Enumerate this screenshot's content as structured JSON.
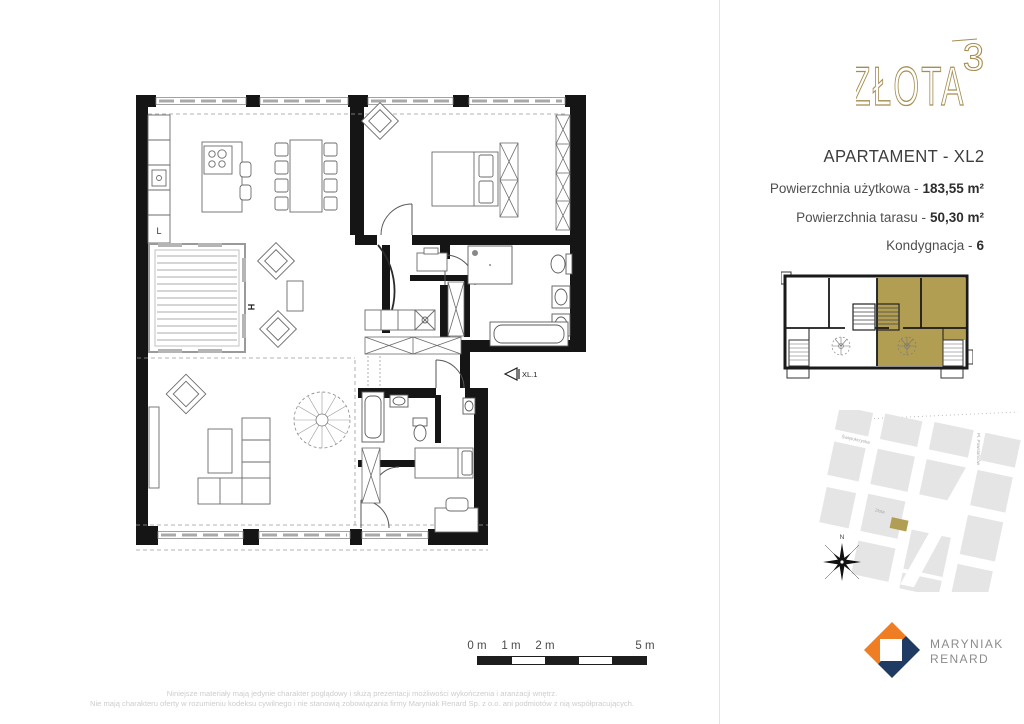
{
  "brand": {
    "logo_text": "ZŁOTA",
    "logo_sup": "3",
    "gold": "#a68e51"
  },
  "apartment": {
    "title": "APARTAMENT - XL2",
    "specs": [
      {
        "label": "Powierzchnia użytkowa -",
        "value": "183,55 m²"
      },
      {
        "label": "Powierzchnia tarasu -",
        "value": "50,30 m²"
      },
      {
        "label": "Kondygnacja -",
        "value": "6"
      }
    ]
  },
  "floor_plan": {
    "entrance_label": "XL.1",
    "fridge_label": "L",
    "garden_label": "H"
  },
  "mini_plan": {
    "highlight_color": "#b29e52"
  },
  "site_map": {
    "street_label_1": "Świętokrzyska",
    "street_label_2": "Złota",
    "street_label_3": "Pl. Powstańców",
    "compass_label": "N",
    "marker_color": "#b29e52"
  },
  "scale_bar": {
    "labels": [
      "0 m",
      "1 m",
      "2 m",
      "5 m"
    ]
  },
  "developer": {
    "line1": "MARYNIAK",
    "line2": "RENARD",
    "orange": "#ee7d23",
    "navy": "#1f3a63"
  },
  "disclaimer": {
    "line1": "Niniejsze materiały mają jedynie charakter poglądowy i służą prezentacji możliwości wykończenia i aranżacji wnętrz.",
    "line2": "Nie mają charakteru oferty w rozumieniu kodeksu cywilnego i nie stanowią zobowiązania firmy Maryniak Renard Sp. z o.o. ani podmiotów z nią współpracujących."
  }
}
